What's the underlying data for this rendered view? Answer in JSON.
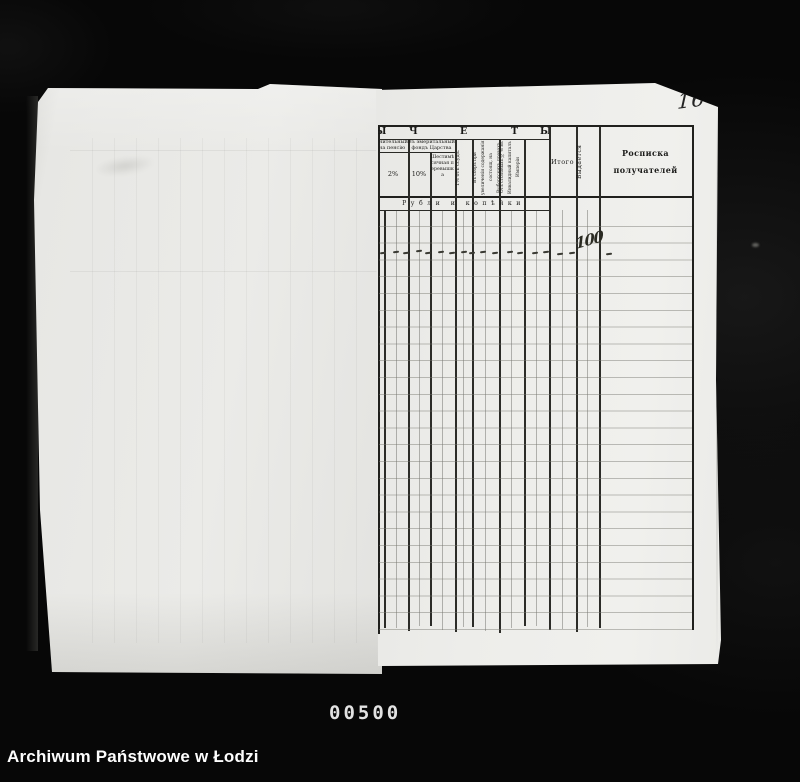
{
  "archive": {
    "watermark": "Archiwum Państwowe w Łodzi",
    "frame_counter": "00500"
  },
  "page": {
    "handwritten_page_number": "16"
  },
  "ledger": {
    "band_letters": [
      "Ы",
      "Ч",
      "Е",
      "Т",
      "Ы"
    ],
    "columns": {
      "pension_fragment": "нительный на пенсію",
      "pension_rate": "2%",
      "emerital_group": "Въ эмеритальный фондъ Царства",
      "emerital_rate": "10%",
      "six_month_surplus": "Шестимѣсячная перевышка",
      "loans_percent": "1% отъ ссудъ.",
      "salary_increase_levy": "Въ сборъ при увеличеніи содержанія состоящ. на Выборгскихъ правахъ",
      "invalid_capital_levy": "Отъ столовыхъ ½% въ Инвалидный капиталъ Имперіи",
      "total": "Итого",
      "issued": "Выдается",
      "receipt_line1": "Росписка",
      "receipt_line2": "получателей"
    },
    "currency_band": "Рубли и копѣйки",
    "entry_row": {
      "total_value": "100",
      "dash_marks": [
        [
          380,
          252
        ],
        [
          393,
          251
        ],
        [
          403,
          252
        ],
        [
          416,
          250
        ],
        [
          425,
          252
        ],
        [
          438,
          251
        ],
        [
          449,
          252
        ],
        [
          461,
          251
        ],
        [
          469,
          252
        ],
        [
          480,
          251
        ],
        [
          492,
          252
        ],
        [
          507,
          251
        ],
        [
          517,
          252
        ],
        [
          532,
          252
        ],
        [
          543,
          251
        ],
        [
          557,
          253
        ],
        [
          569,
          252
        ],
        [
          606,
          253
        ]
      ]
    }
  }
}
